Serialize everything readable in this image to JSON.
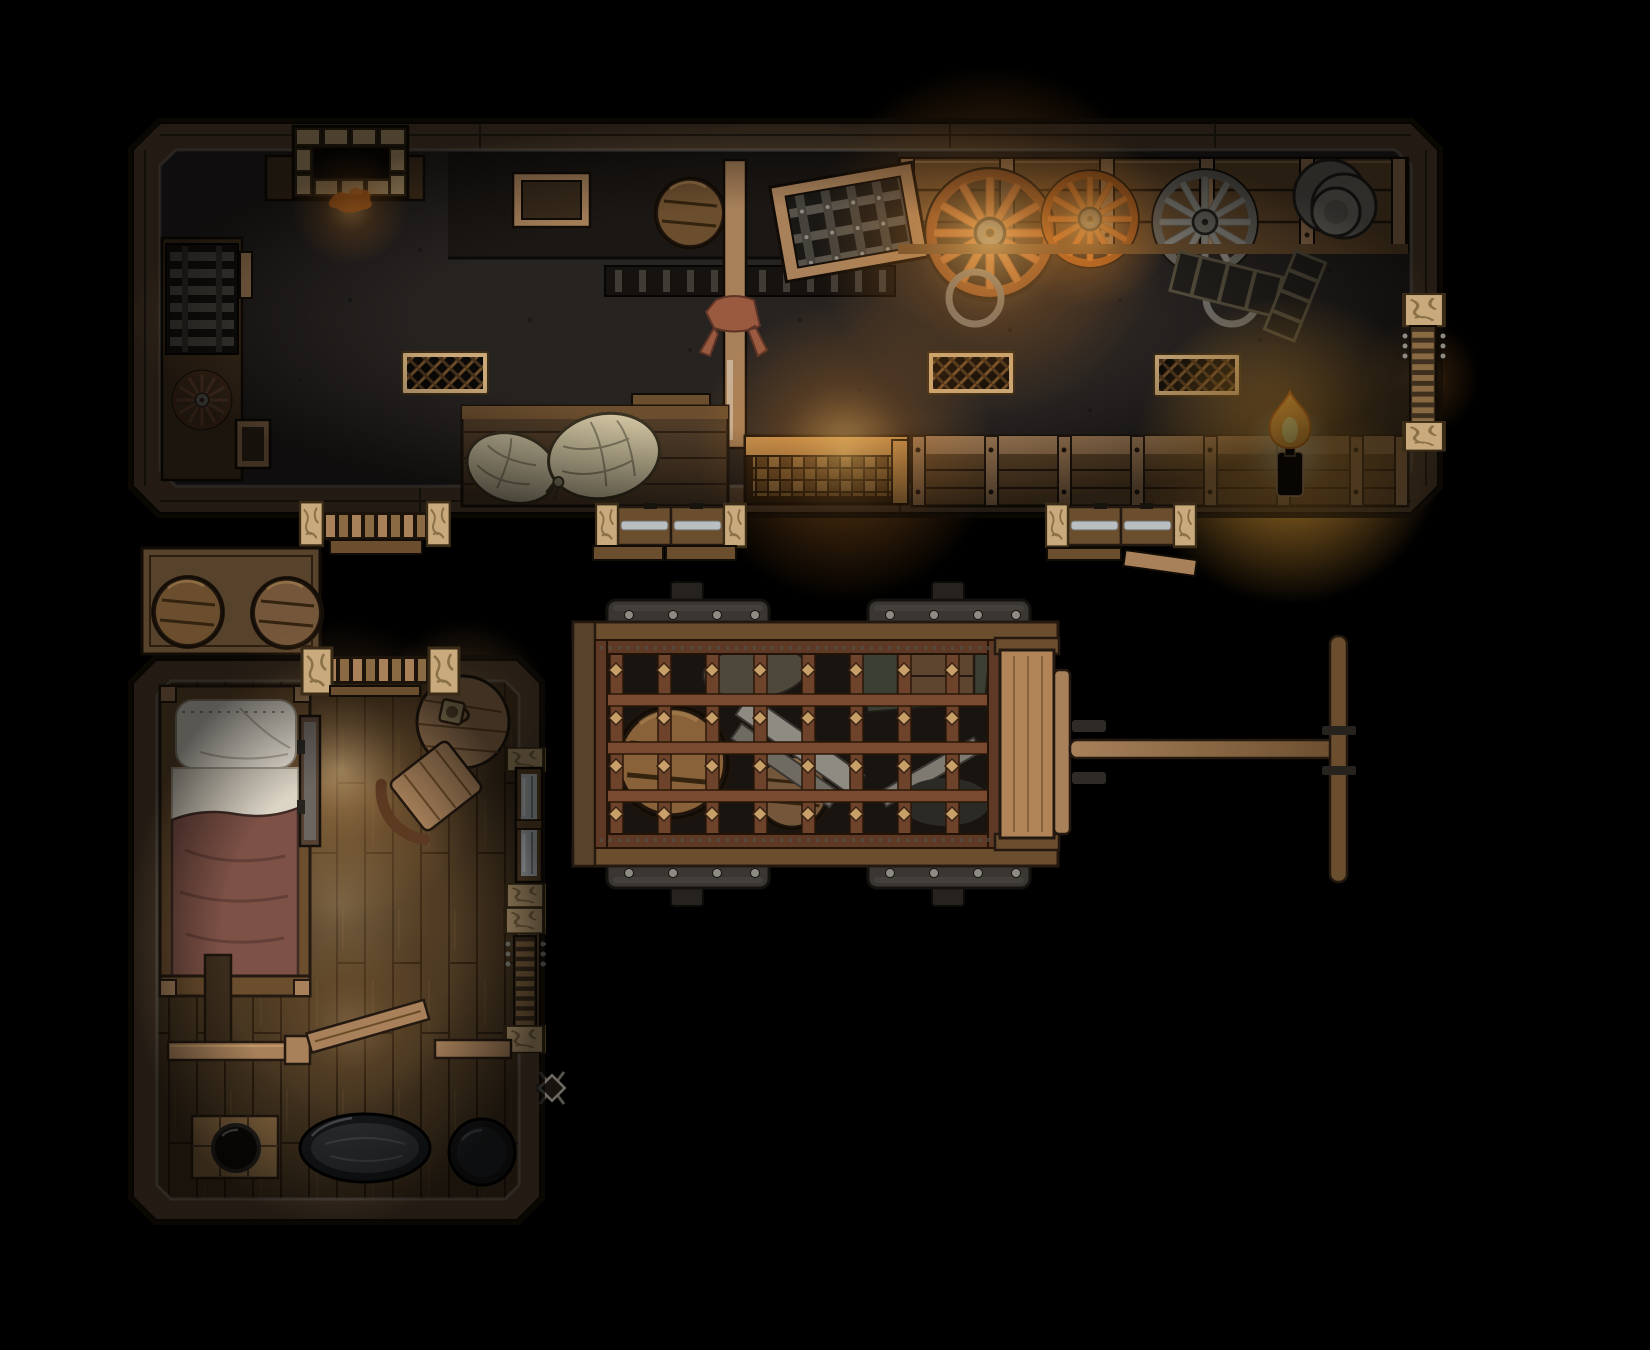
{
  "canvas": {
    "width": 1650,
    "height": 1350,
    "viewBox": "0 0 1650 1350",
    "background": "#000000"
  },
  "palette": {
    "bg": "#000000",
    "wallWood": "#5d4833",
    "wallWoodDark": "#3e2f1f",
    "floorStone": "#272321",
    "floorPlank": "#43331f",
    "stoneBlock": "#c9aa7c",
    "woodLight": "#a8815a",
    "woodMid": "#6b4e2e",
    "woodDark": "#4a3621",
    "woodLit": "#d19a55",
    "metalDark": "#2e2b27",
    "metalMid": "#55524c",
    "metalLight": "#8e8b82",
    "silverBand": "#b9bec2",
    "rust": "#6e432c",
    "copper": "#b06a35",
    "orangeWheel": "#c8742f",
    "silverWheel": "#8e8b82",
    "linen": "#cfc3a0",
    "pillow": "#e9e4d8",
    "sheet": "#dcd5c6",
    "blanket": "#7d5146",
    "glass": "#cdd4d8",
    "tub": "#17181a",
    "water": "#2c2f31",
    "flameMid": "#ffb13d",
    "flameCore": "#ffe27a",
    "cloth": "#9a5a40"
  },
  "scene": {
    "rooms": [
      {
        "id": "workshop-hall",
        "label": "long workshop / storage hall"
      },
      {
        "id": "bedroom",
        "label": "small bedroom with bath corner"
      }
    ],
    "objects": [
      {
        "id": "fireplace",
        "label": "brick fireplace with embers"
      },
      {
        "id": "drying-rack",
        "label": "metal rack on side counter"
      },
      {
        "id": "small-wheel",
        "label": "small wagon wheel"
      },
      {
        "id": "storage-crates",
        "label": "wooden crates"
      },
      {
        "id": "barrel",
        "label": "wooden barrel (top view)"
      },
      {
        "id": "support-post",
        "label": "wooden post with tied cloth"
      },
      {
        "id": "tilted-grate",
        "label": "framed metal grate leaning"
      },
      {
        "id": "wheel-copper",
        "label": "large copper wagon wheel"
      },
      {
        "id": "wheel-orange",
        "label": "orange wagon wheel"
      },
      {
        "id": "wheel-silver",
        "label": "silver wagon wheel"
      },
      {
        "id": "plate-stack",
        "label": "stack of metal plates"
      },
      {
        "id": "floor-grate",
        "label": "floor vent grate"
      },
      {
        "id": "sack-table",
        "label": "table with grain sacks"
      },
      {
        "id": "lattice-bench",
        "label": "lit lattice workbench"
      },
      {
        "id": "crate-bench",
        "label": "row of crate benches"
      },
      {
        "id": "candle",
        "label": "burning candle in bottle"
      },
      {
        "id": "double-door",
        "label": "double door with metal bars"
      },
      {
        "id": "walkway",
        "label": "slatted walkway step"
      },
      {
        "id": "wall-ladder",
        "label": "ladder at wall opening"
      },
      {
        "id": "loose-plank",
        "label": "loose wooden plank"
      },
      {
        "id": "barrel-shelf",
        "label": "platform with two barrels"
      },
      {
        "id": "bed",
        "label": "bed with pillow, sheet and blanket"
      },
      {
        "id": "mirror-panel",
        "label": "narrow panel beside bed"
      },
      {
        "id": "round-table",
        "label": "round table with tankard"
      },
      {
        "id": "chair",
        "label": "curved-back chair"
      },
      {
        "id": "window",
        "label": "glazed window in wall"
      },
      {
        "id": "wall-lantern",
        "label": "outside wall lantern"
      },
      {
        "id": "half-wall",
        "label": "interior half wall with open door"
      },
      {
        "id": "cauldron-pallet",
        "label": "pallet with black cauldron"
      },
      {
        "id": "bathtub",
        "label": "oval bathtub"
      },
      {
        "id": "wash-tub",
        "label": "round wash tub"
      },
      {
        "id": "cage-wagon",
        "label": "iron cage wagon full of goods"
      },
      {
        "id": "tow-bar",
        "label": "wagon tow bar with crossbar"
      }
    ]
  }
}
